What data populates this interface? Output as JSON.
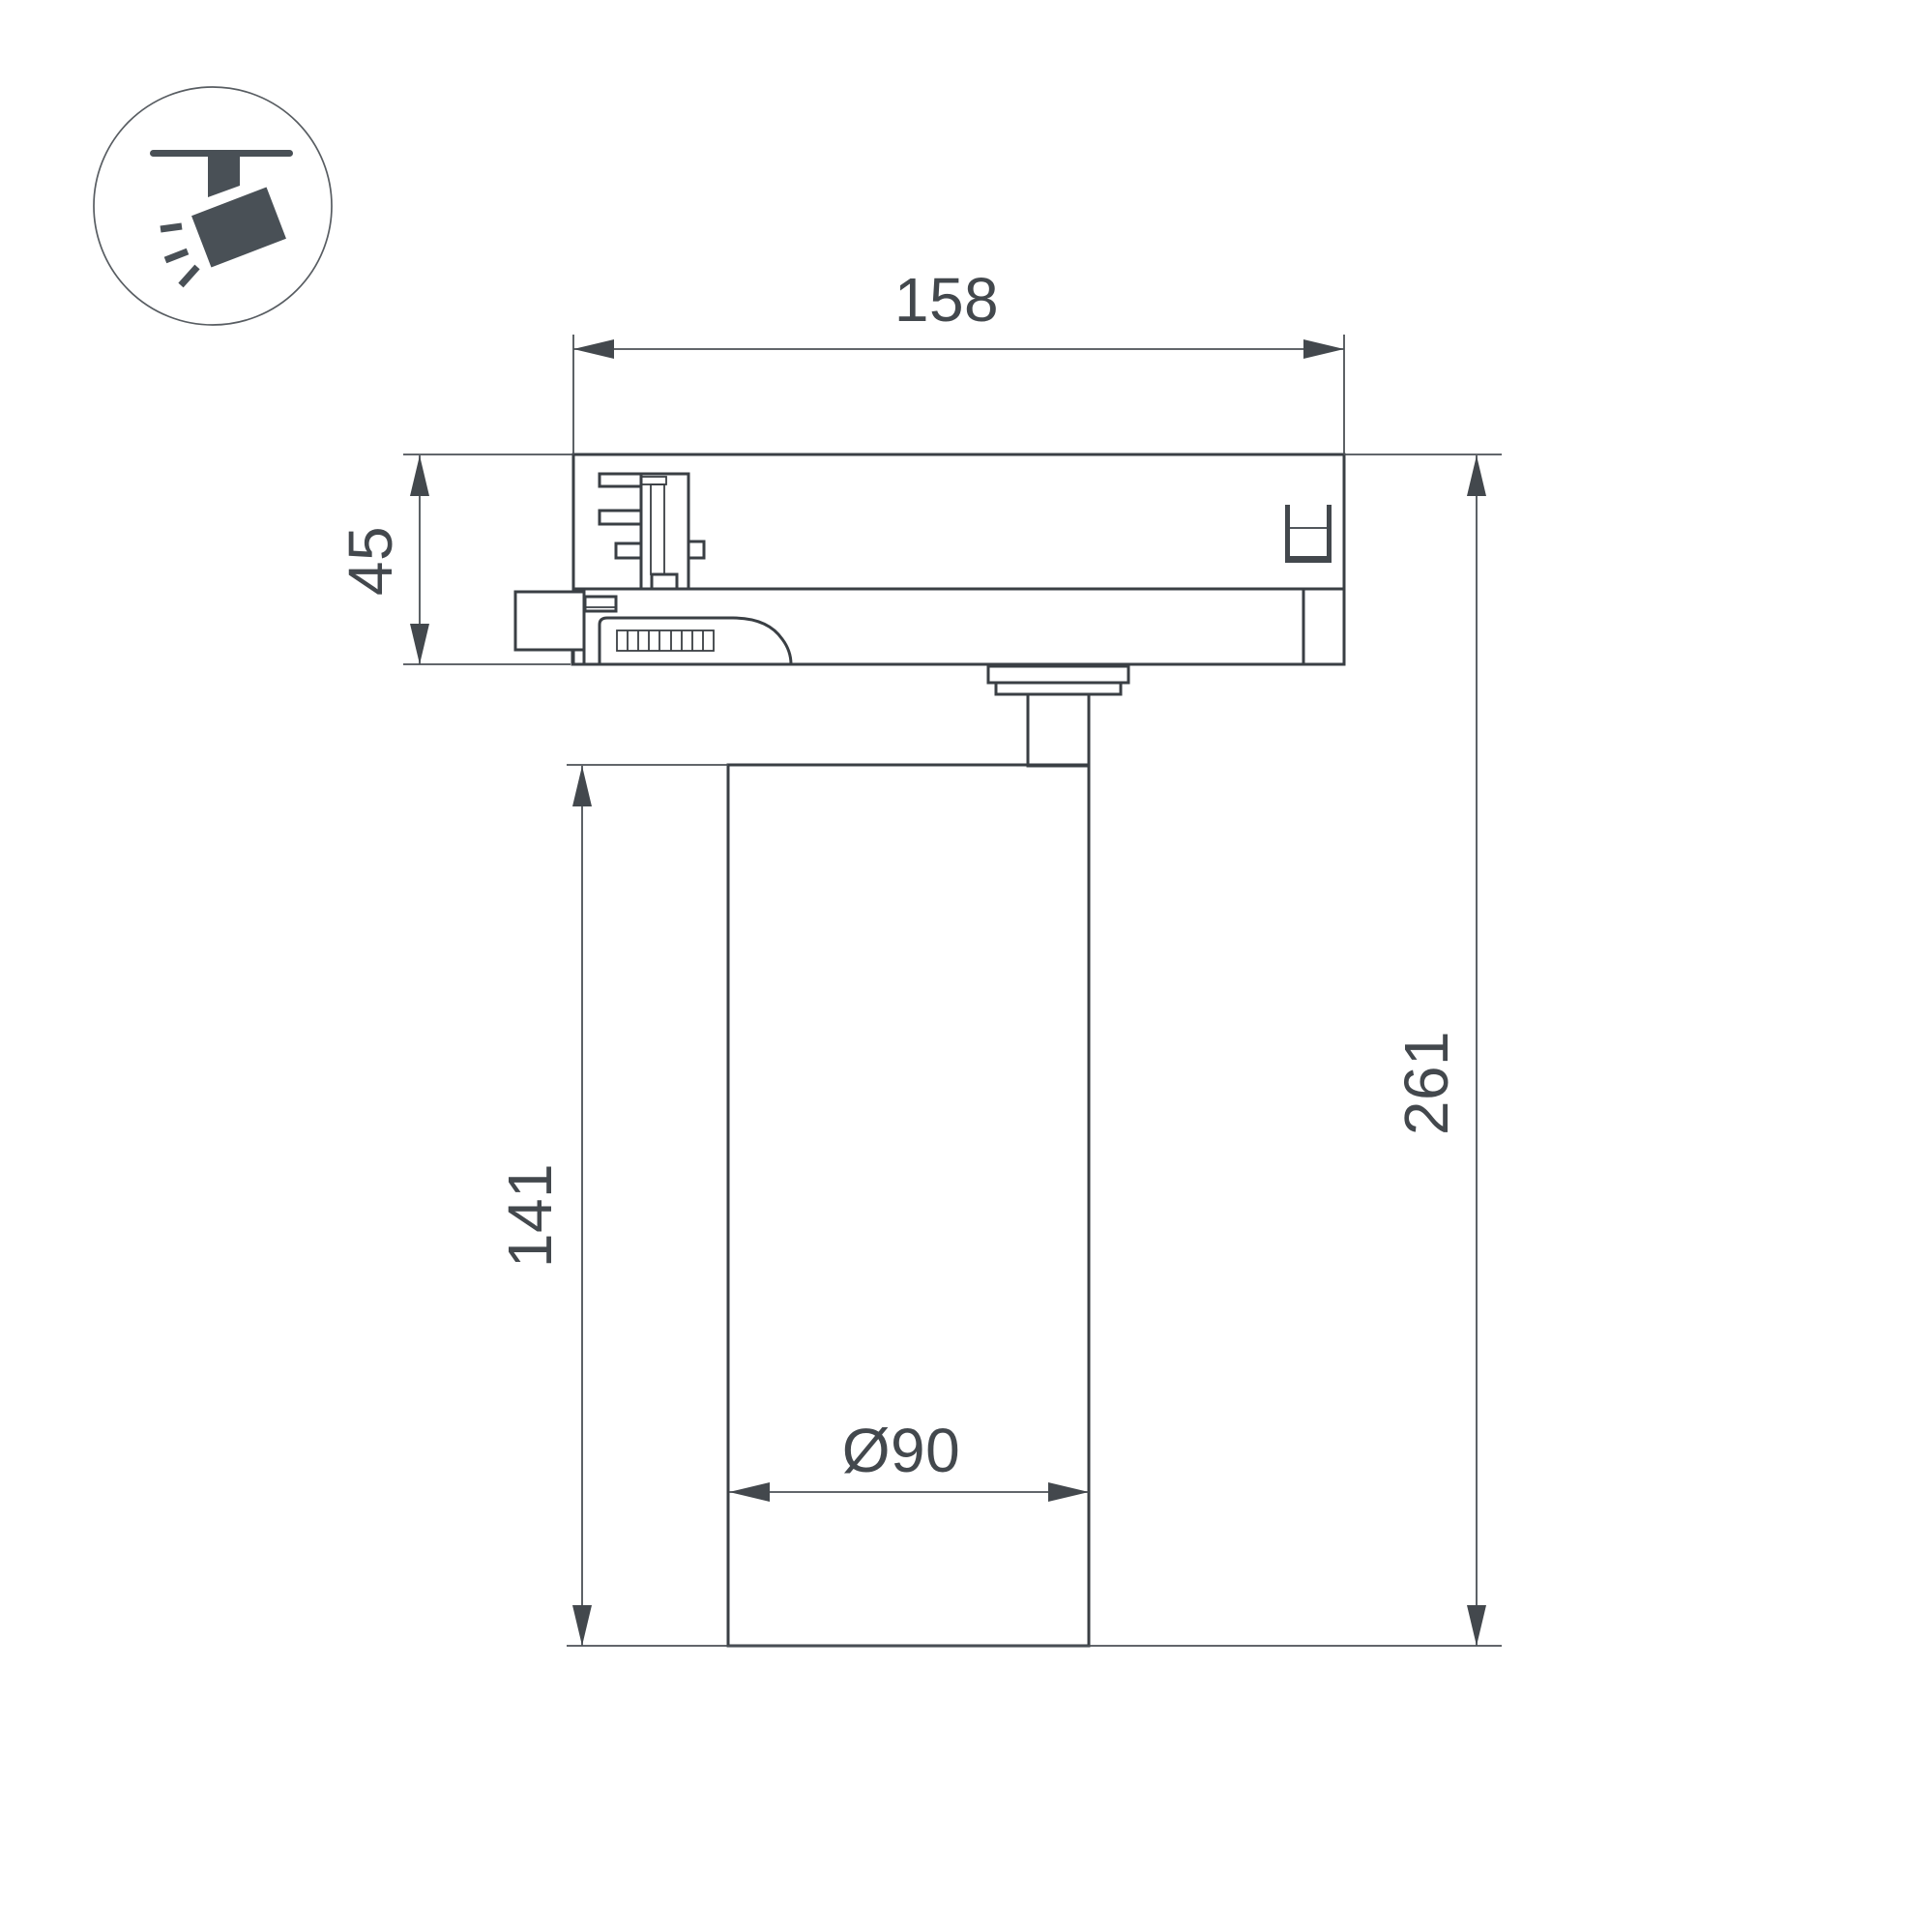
{
  "icon": {
    "name": "track-spotlight-icon"
  },
  "drawing": {
    "labels": {
      "track_adapter_width": "158",
      "adapter_height": "45",
      "body_height": "141",
      "total_height": "261",
      "body_diameter": "Ø90"
    },
    "colors": {
      "outline": "#3a3f44",
      "dimension_line": "#4b5156",
      "text": "#43484d",
      "icon": "#495056",
      "background": "#ffffff"
    }
  }
}
